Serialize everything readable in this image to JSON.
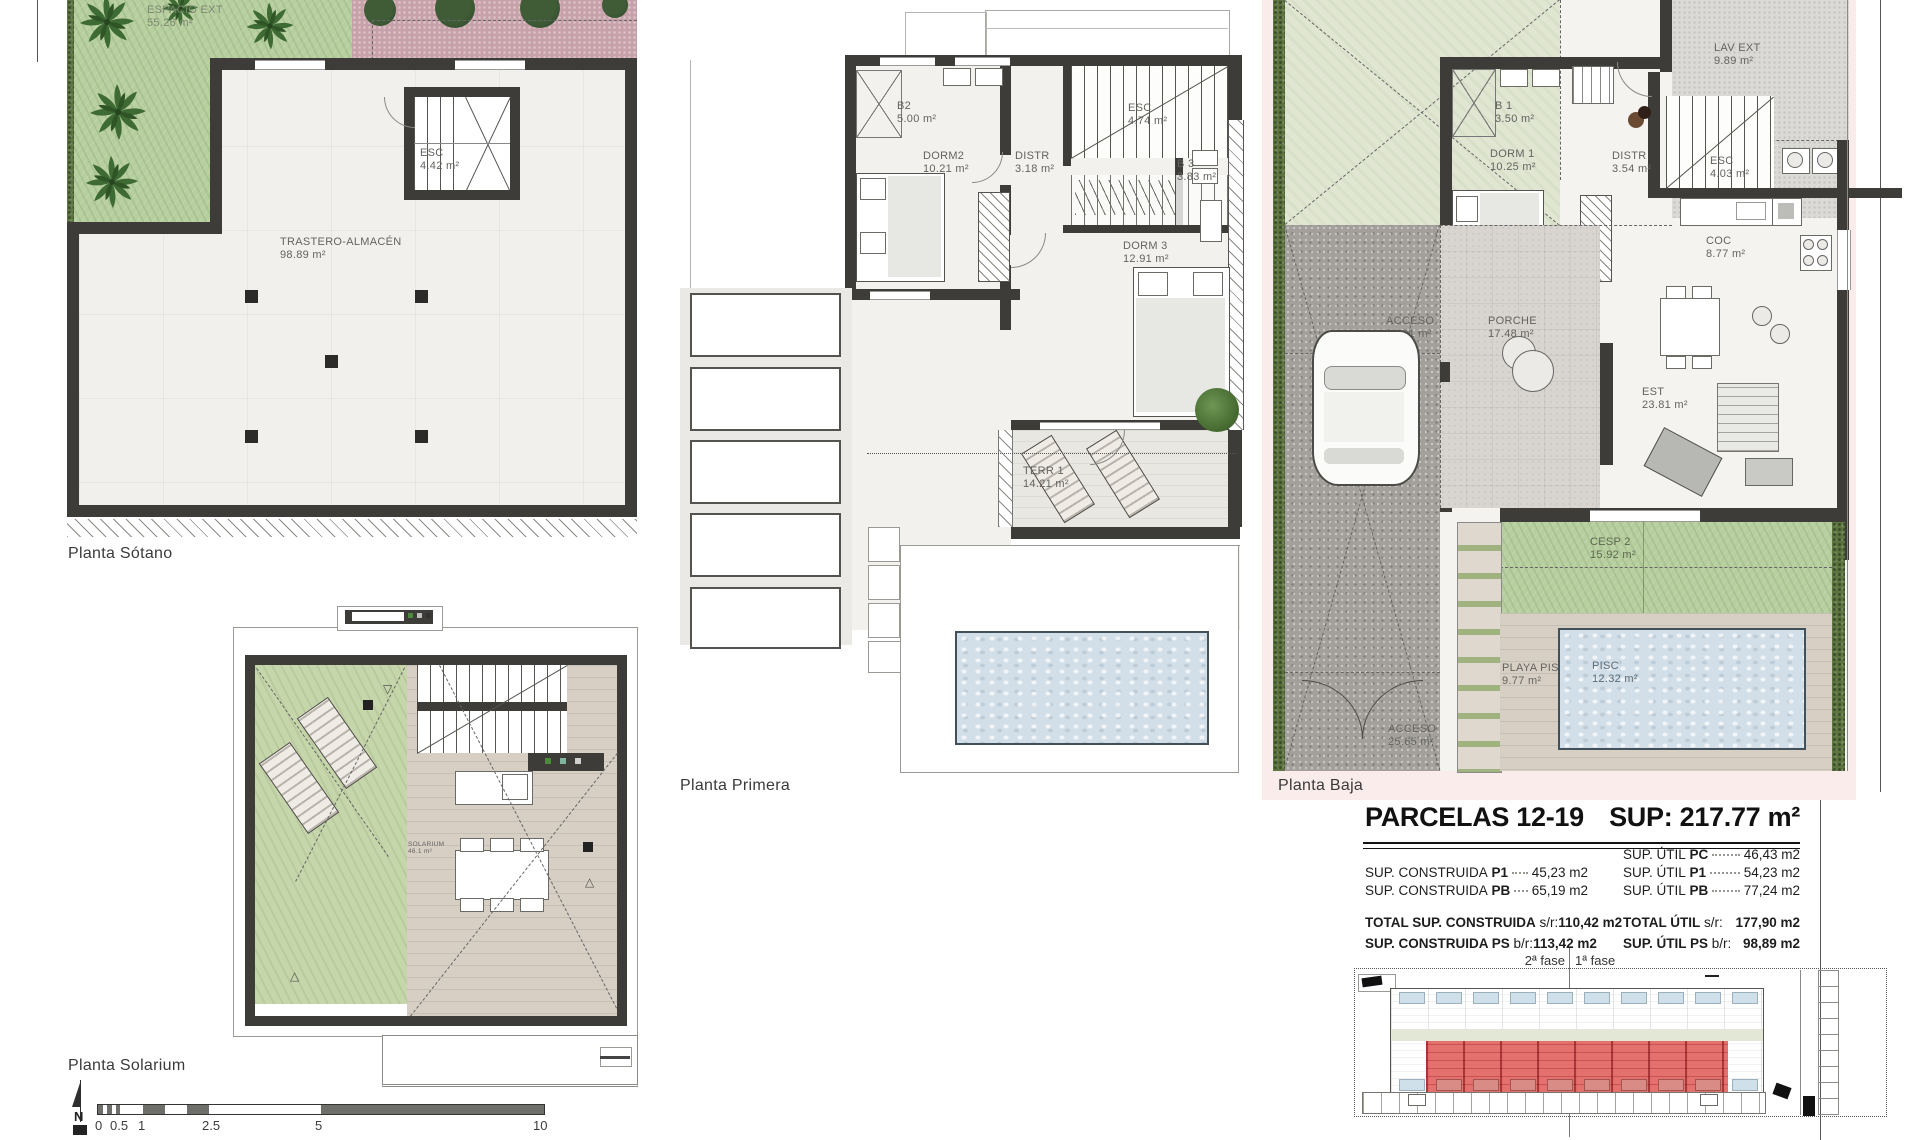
{
  "plans": {
    "sotano": {
      "caption": "Planta Sótano",
      "rooms": {
        "espacio": {
          "name": "ESPACIO EXT",
          "area": "55.26 m²"
        },
        "esc": {
          "name": "ESC",
          "area": "4.42 m²"
        },
        "trastero": {
          "name": "TRASTERO-ALMACÉN",
          "area": "98.89 m²"
        }
      }
    },
    "primera": {
      "caption": "Planta Primera",
      "rooms": {
        "b2": {
          "name": "B2",
          "area": "5.00 m²"
        },
        "dorm2": {
          "name": "DORM2",
          "area": "10.21 m²"
        },
        "distr": {
          "name": "DISTR",
          "area": "3.18 m²"
        },
        "esc": {
          "name": "ESC",
          "area": "4.74 m²"
        },
        "b3": {
          "name": "B 3",
          "area": "3.83 m²"
        },
        "dorm3": {
          "name": "DORM 3",
          "area": "12.91 m²"
        },
        "terr1": {
          "name": "TERR 1",
          "area": "14.21 m²"
        }
      }
    },
    "baja": {
      "caption": "Planta Baja",
      "rooms": {
        "lav": {
          "name": "LAV EXT",
          "area": "9.89 m²"
        },
        "b1": {
          "name": "B 1",
          "area": "3.50 m²"
        },
        "dorm1": {
          "name": "DORM 1",
          "area": "10.25 m²"
        },
        "distr": {
          "name": "DISTR",
          "area": "3.54 m²"
        },
        "esc": {
          "name": "ESC",
          "area": "4.03 m²"
        },
        "coc": {
          "name": "COC",
          "area": "8.77 m²"
        },
        "acceso": {
          "name": "ACCESO",
          "area": "21.91 m²"
        },
        "porche": {
          "name": "PORCHE",
          "area": "17.48 m²"
        },
        "est": {
          "name": "EST",
          "area": "23.81 m²"
        },
        "cesp2": {
          "name": "CESP 2",
          "area": "15.92 m²"
        },
        "playa": {
          "name": "PLAYA PISC",
          "area": "9.77 m²"
        },
        "pisc": {
          "name": "PISC",
          "area": "12.32 m²"
        },
        "acceso2": {
          "name": "ACCESO",
          "area": "25.65 m²"
        }
      }
    },
    "solarium": {
      "caption": "Planta Solarium",
      "rooms": {
        "solarium": {
          "name": "SOLARIUM",
          "area": "46.1 m²"
        }
      }
    }
  },
  "summary": {
    "title": "PARCELAS 12-19",
    "sup_total": "SUP: 217.77 m²",
    "left_rows": [
      {
        "label": "SUP. CONSTRUIDA",
        "bold": "P1",
        "value": "45,23 m2"
      },
      {
        "label": "SUP. CONSTRUIDA",
        "bold": "PB",
        "value": "65,19 m2"
      }
    ],
    "right_rows": [
      {
        "label": "SUP. ÚTIL",
        "bold": "PC",
        "value": "46,43 m2"
      },
      {
        "label": "SUP. ÚTIL",
        "bold": "P1",
        "value": "54,23 m2"
      },
      {
        "label": "SUP. ÚTIL",
        "bold": "PB",
        "value": "77,24 m2"
      }
    ],
    "left_totals": [
      {
        "bold": "TOTAL SUP. CONSTRUIDA",
        "suffix": "s/r:",
        "value": "110,42 m2"
      },
      {
        "bold": "SUP. CONSTRUIDA PS",
        "suffix": "b/r:",
        "value": "113,42 m2"
      }
    ],
    "right_totals": [
      {
        "bold": "TOTAL ÚTIL",
        "suffix": "s/r:",
        "value": "177,90 m2"
      },
      {
        "bold": "SUP. ÚTIL PS",
        "suffix": "b/r:",
        "value": "98,89 m2"
      }
    ]
  },
  "site": {
    "phase_left": "2ª fase",
    "phase_right": "1ª fase"
  },
  "scalebar": {
    "ticks": [
      "0",
      "0.5",
      "1",
      "2.5",
      "5",
      "10"
    ]
  },
  "north": {
    "label": "N"
  }
}
